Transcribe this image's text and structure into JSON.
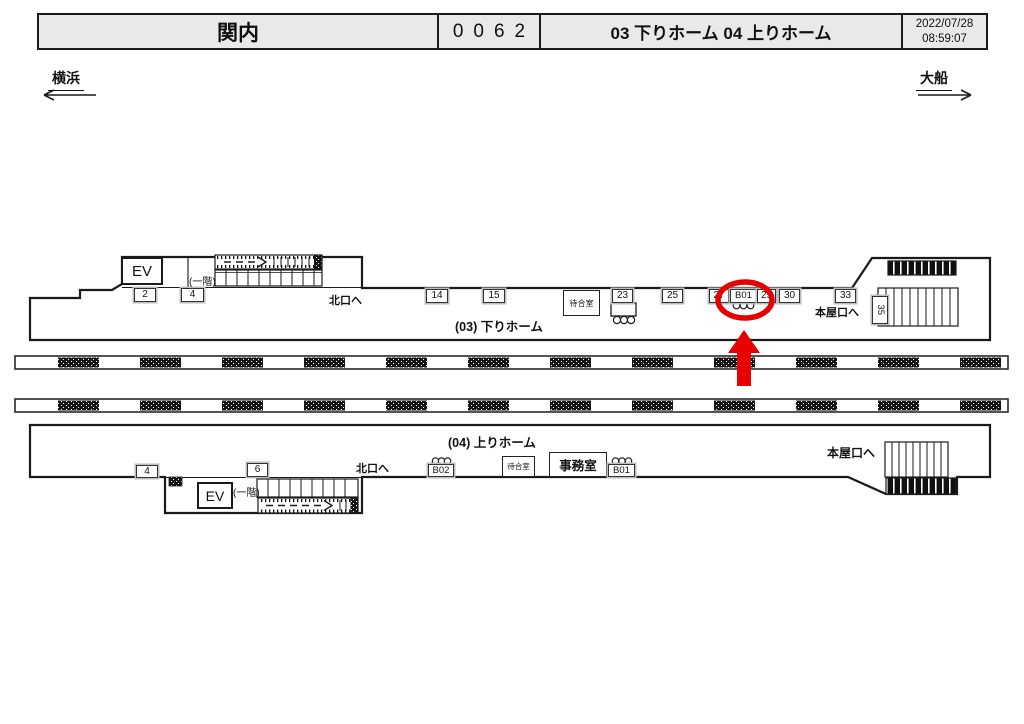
{
  "header": {
    "station": "関内",
    "code": "0062",
    "platforms": "03 下りホーム 04 上りホーム",
    "date": "2022/07/28",
    "time": "08:59:07"
  },
  "directions": {
    "left": "横浜",
    "right": "大船"
  },
  "platform_down": {
    "title": "(03) 下りホーム",
    "ev": "EV",
    "floor": "(一階)",
    "north_exit": "北口へ",
    "main_exit": "本屋口へ",
    "waiting_room": "待合室",
    "m2": "2",
    "m4": "4",
    "m14": "14",
    "m15": "15",
    "m23": "23",
    "m25": "25",
    "m27": "27",
    "mB01": "B01",
    "m29": "29",
    "m30": "30",
    "m33": "33",
    "m35": "35"
  },
  "platform_up": {
    "title": "(04) 上りホーム",
    "ev": "EV",
    "floor": "(一階)",
    "north_exit": "北口へ",
    "main_exit": "本屋口へ",
    "waiting_room": "待合室",
    "office": "事務室",
    "m4": "4",
    "m6": "6",
    "mB02": "B02",
    "mB01": "B01"
  },
  "annotation": {
    "highlighted_marker": "B01",
    "color": "#e60000"
  }
}
